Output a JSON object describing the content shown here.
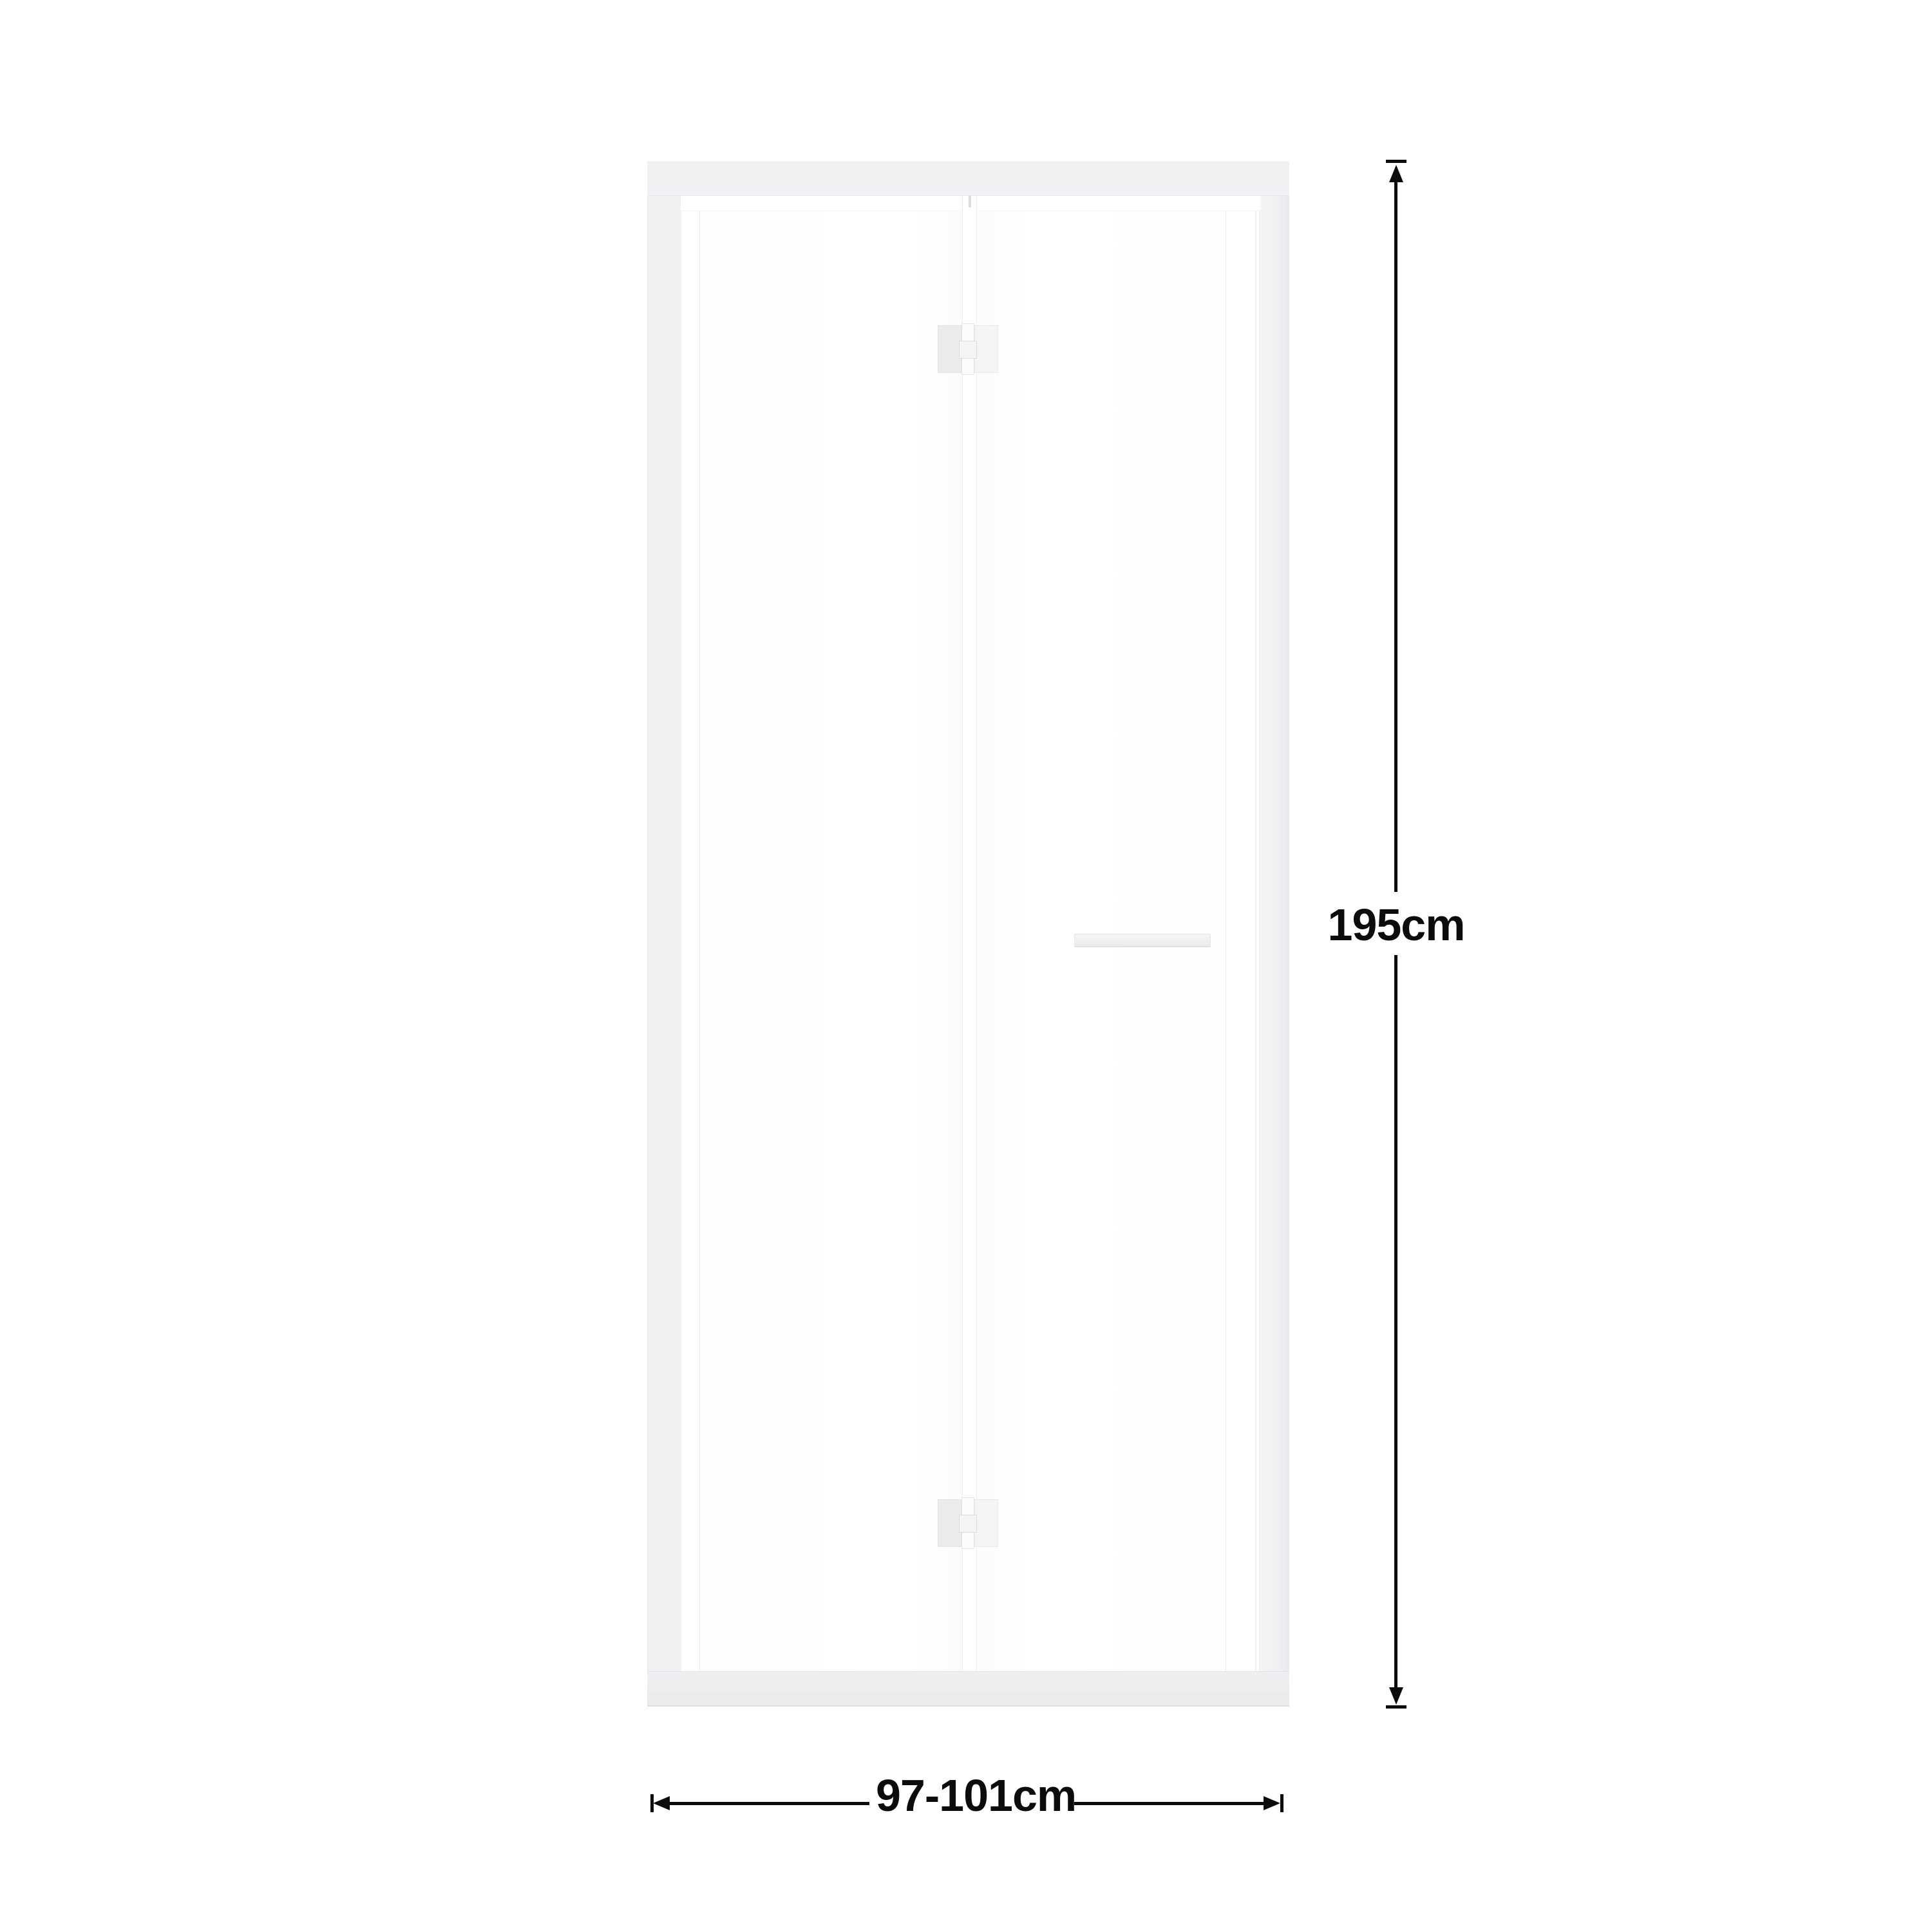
{
  "diagram": {
    "background_color": "#ffffff",
    "door": {
      "frame_color": "#eff1f2",
      "sill_color": "#e9ebec",
      "glass_color": "#fefefe",
      "seam_line_color": "#e9edee",
      "hinge_count": 2
    },
    "dimensions": {
      "line_color": "#0c0c0c",
      "height_label": "195cm",
      "width_label": "97-101cm"
    }
  }
}
